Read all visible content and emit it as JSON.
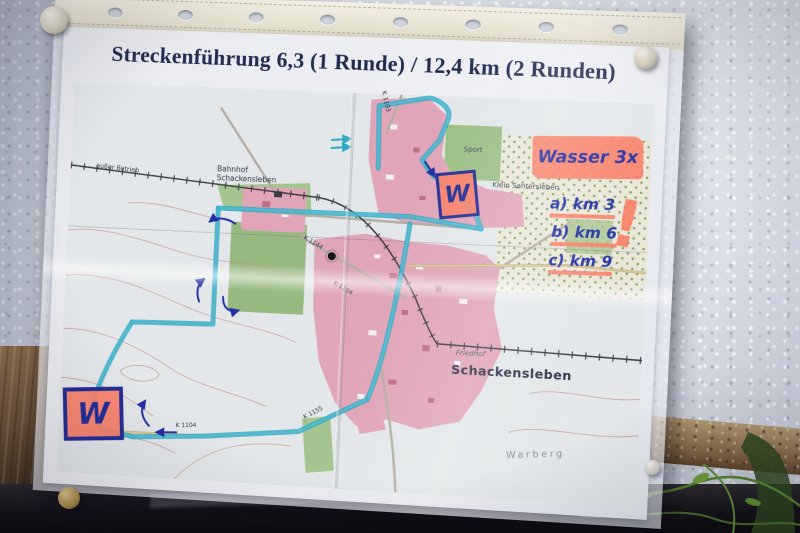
{
  "photo": {
    "title": "Streckenführung 6,3 (1 Runde) / 12,4 km (2 Runden)",
    "handwritten": {
      "water_note": "Wasser 3x",
      "water_points": [
        "a) km 3",
        "b) km 6",
        "c) km 9"
      ],
      "water_station_mark": "W",
      "exclamation_mark": "!"
    },
    "map_labels": {
      "town_main": "Schackensleben",
      "town_small": "Klein Santersleben",
      "station": "Bahnhof Schackensleben",
      "cemetery": "Friedhof",
      "sports_field": "Sport",
      "hill": "Warberg",
      "railway_note": "außer Betrieb",
      "road_1": "K 1103",
      "road_2": "K 1144",
      "road_3": "K 1104",
      "road_4": "K 1155"
    },
    "colors": {
      "route": "#2fa9c6",
      "highlighter": "#fa8069",
      "pen": "#2431a4",
      "village_fill": "#e0a5b8",
      "field_green": "#a6c48f"
    }
  }
}
